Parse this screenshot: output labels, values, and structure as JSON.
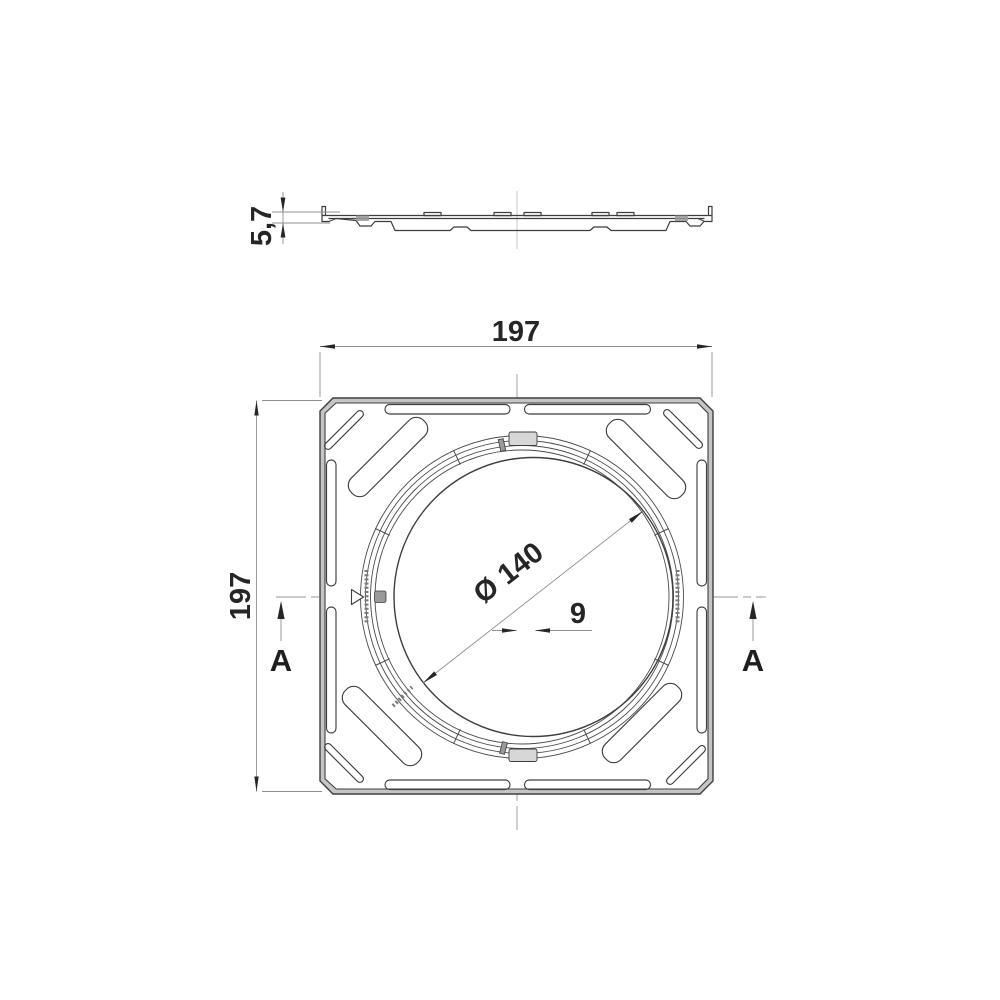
{
  "drawing": {
    "section_view": {
      "thickness_dim": "5,7"
    },
    "plan_view": {
      "width_dim": "197",
      "height_dim": "197",
      "diameter_dim": "Ø 140",
      "offset_dim": "9",
      "section_label_left": "A",
      "section_label_right": "A"
    },
    "colors": {
      "background": "#ffffff",
      "object_line": "#3e3e3e",
      "thin_line": "#8f8f8f",
      "band_fill": "#c5c5c5",
      "text": "#262626"
    }
  }
}
